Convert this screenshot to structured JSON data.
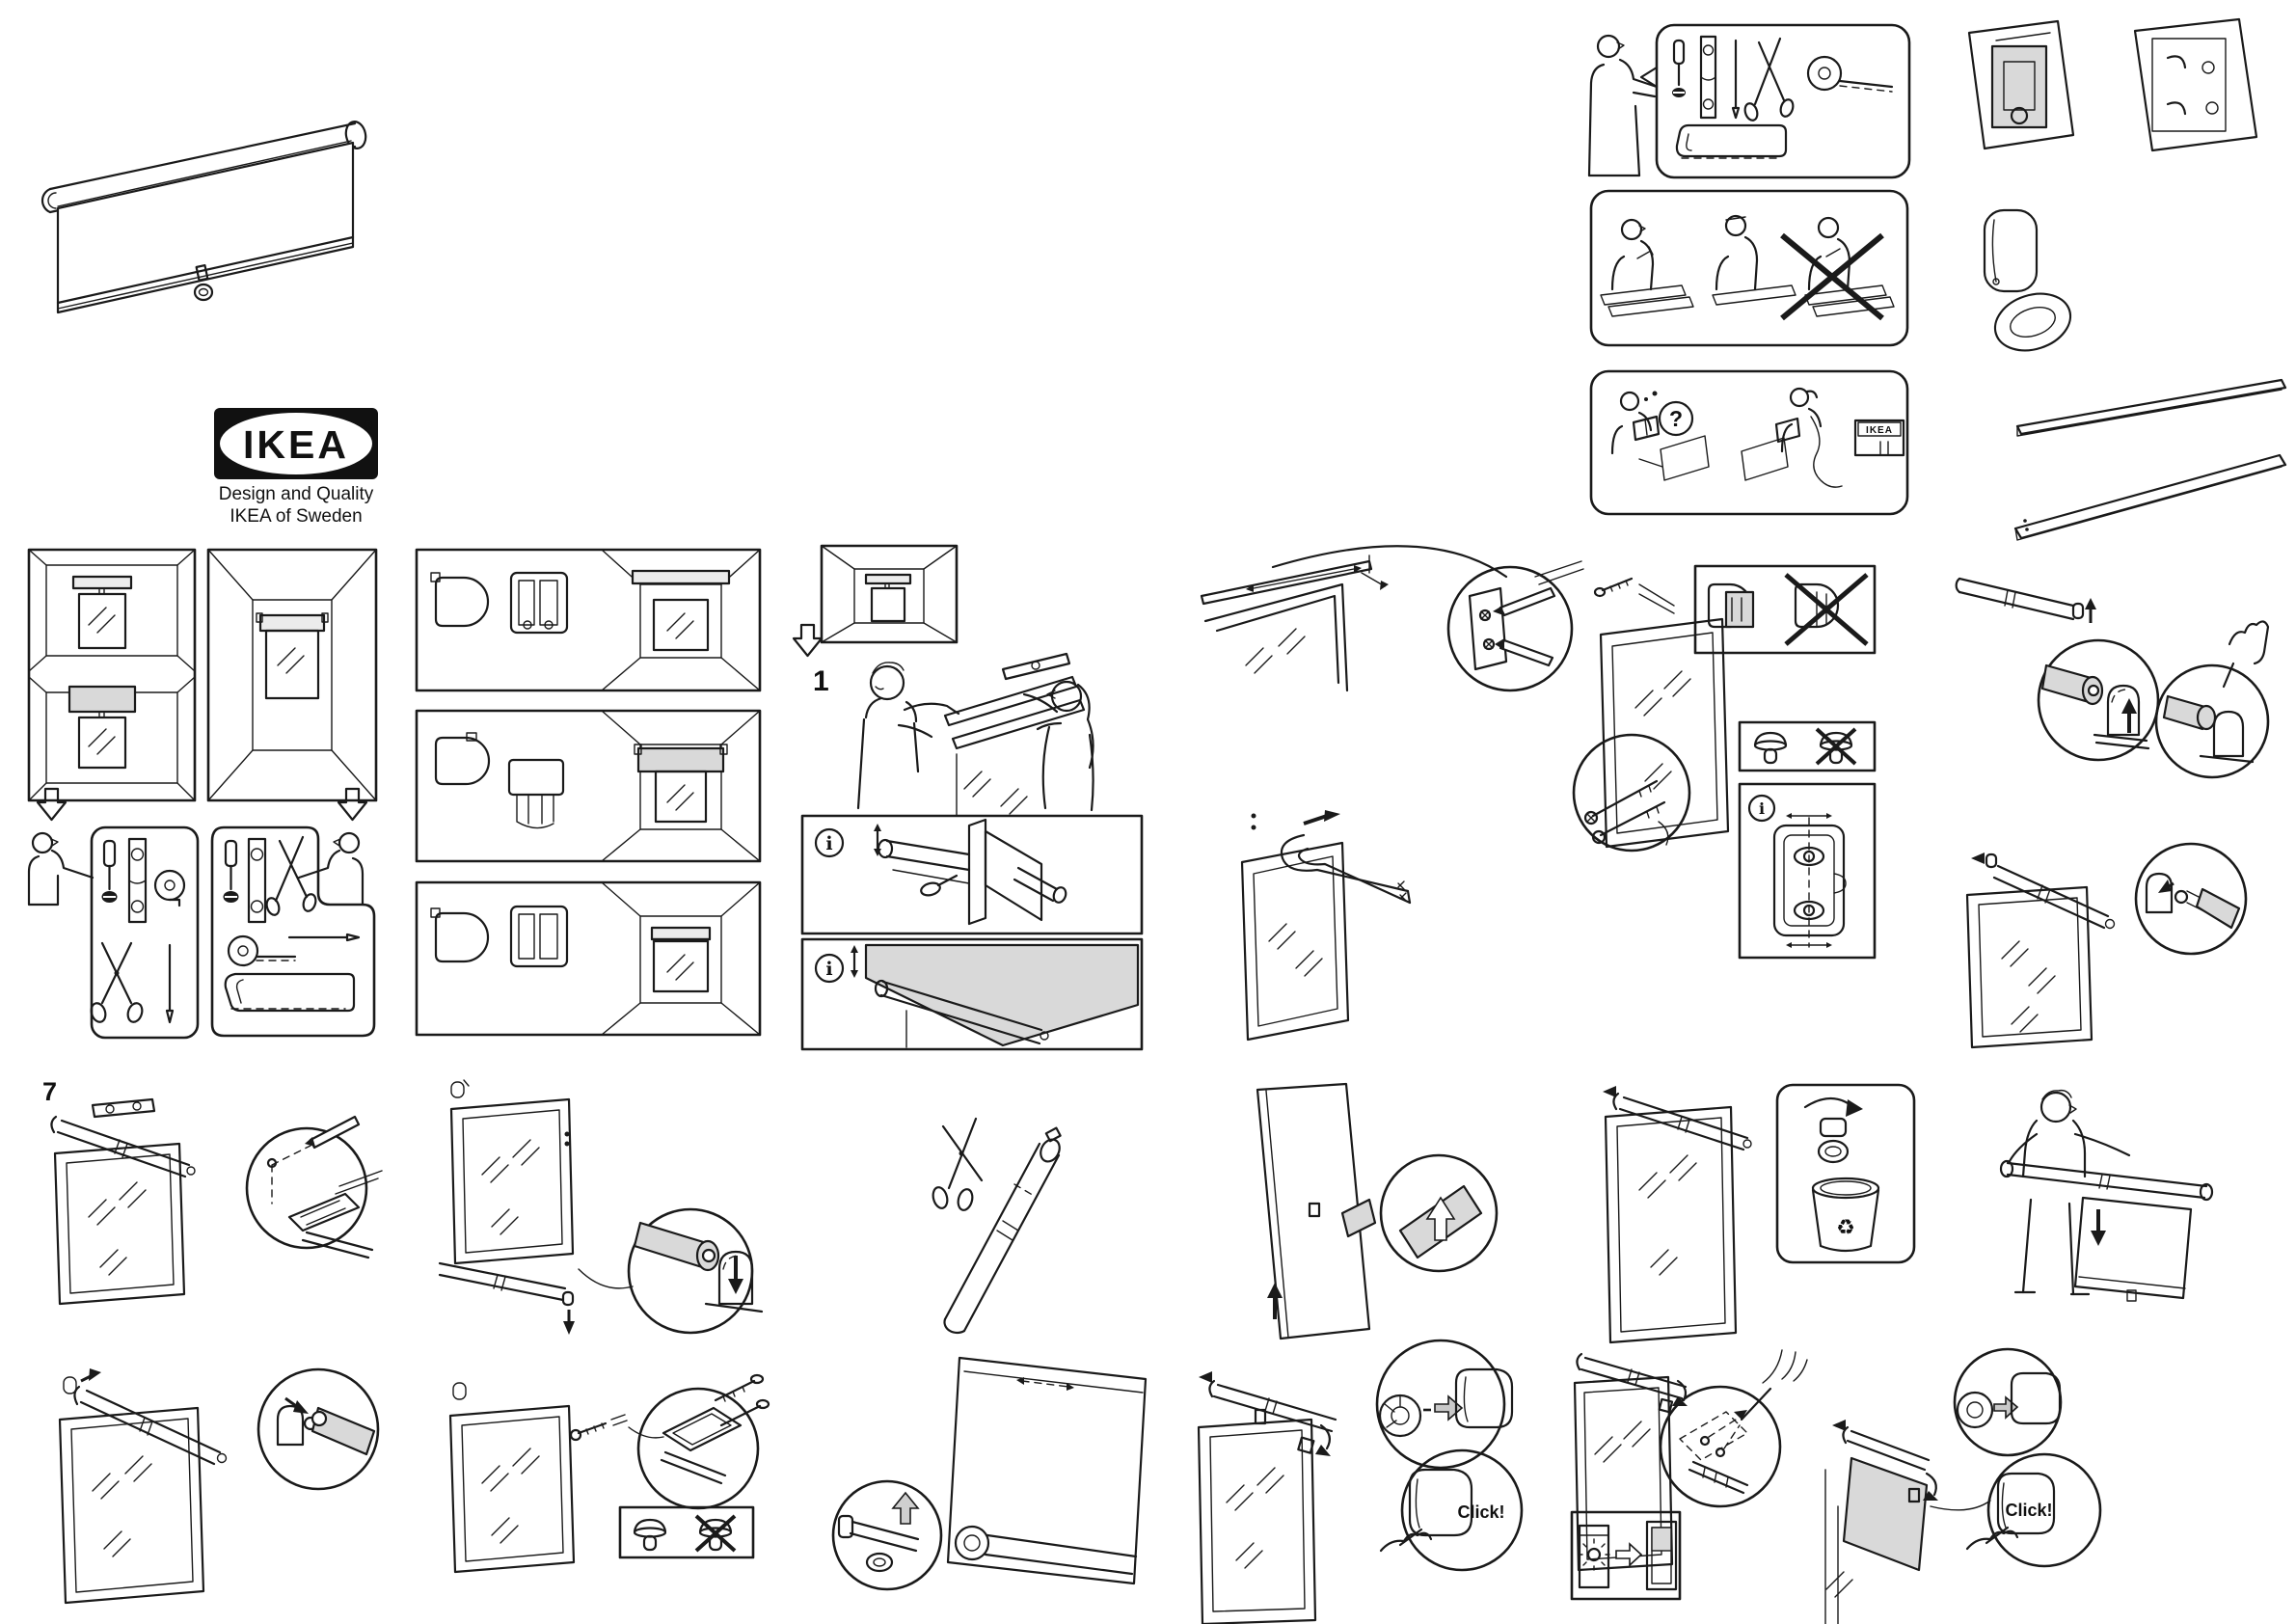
{
  "colors": {
    "paper": "#ffffff",
    "ink": "#1a1a1a",
    "shade_gray": "#d9d9d9"
  },
  "branding": {
    "logo_text": "IKEA",
    "registered_mark": "®",
    "tagline_line1": "Design and Quality",
    "tagline_line2": "IKEA of Sweden",
    "store_sign": "IKEA"
  },
  "steps": {
    "step1": "1",
    "step7": "7"
  },
  "labels": {
    "click": "Click!",
    "question_mark": "?",
    "info_glyph": "i"
  },
  "icons": {
    "recycle": "♻"
  }
}
